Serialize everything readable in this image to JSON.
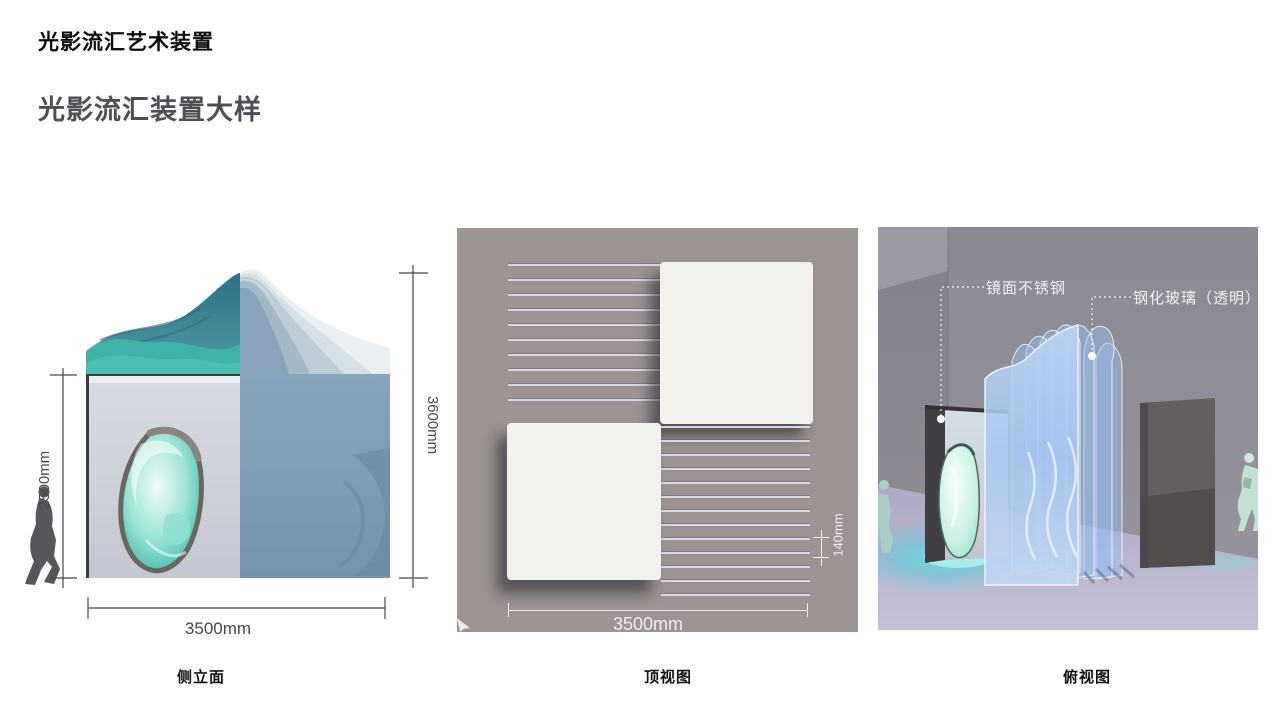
{
  "header": {
    "title": "光影流汇艺术装置",
    "subtitle": "光影流汇装置大样"
  },
  "side_elevation": {
    "caption": "侧立面",
    "dim_height_inner": "2500mm",
    "dim_height_total": "3600mm",
    "dim_width": "3500mm"
  },
  "top_view": {
    "caption": "顶视图",
    "dim_width": "3500mm",
    "dim_spacing": "140mm"
  },
  "perspective": {
    "caption": "俯视图",
    "label_mirror": "镜面不锈钢",
    "label_glass": "钢化玻璃（透明）"
  },
  "colors": {
    "teal_wave": "#3fb2aa",
    "deep_teal": "#2d7689",
    "steel_blue_face": "#7e9cb8",
    "taupe_background": "#9c9392",
    "square_white": "#f3f1ee",
    "glass_blue": "#a9c7ee",
    "floor_lavender": "#b7b3cd",
    "wall_gray": "#8b8b94",
    "dim_text_dark": "#47474b",
    "dim_text_light": "#f2eff5"
  }
}
